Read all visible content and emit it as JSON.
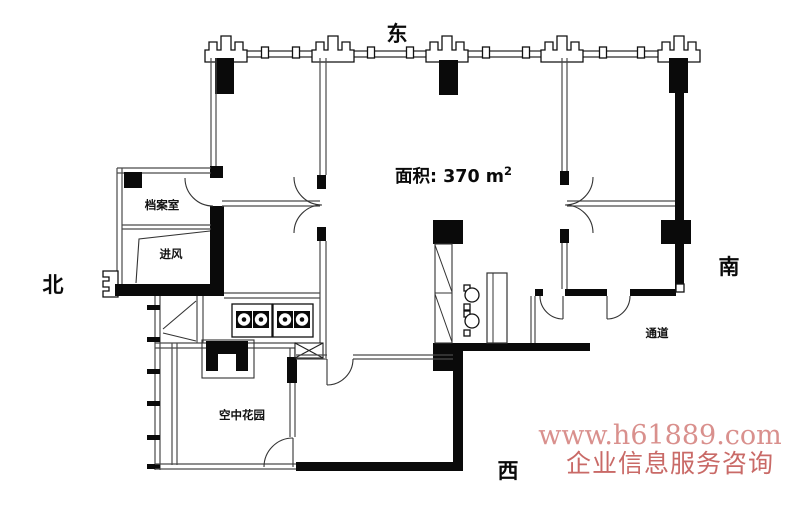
{
  "compass": {
    "east": "东",
    "south": "南",
    "west": "西",
    "north": "北"
  },
  "area": {
    "text": "面积: 370 m",
    "superscript": "2"
  },
  "rooms": {
    "archive": "档案室",
    "air_intake": "进风",
    "sky_garden": "空中花园",
    "passage": "通道"
  },
  "watermark": {
    "line1": "www.h61889.com",
    "line2": "企业信息服务咨询"
  },
  "colors": {
    "wall_black": "#0a0a0a",
    "wall_gray": "#4a4a4a",
    "watermark_pink": "#d9908d",
    "watermark_red": "#c96a67",
    "background": "#ffffff"
  }
}
